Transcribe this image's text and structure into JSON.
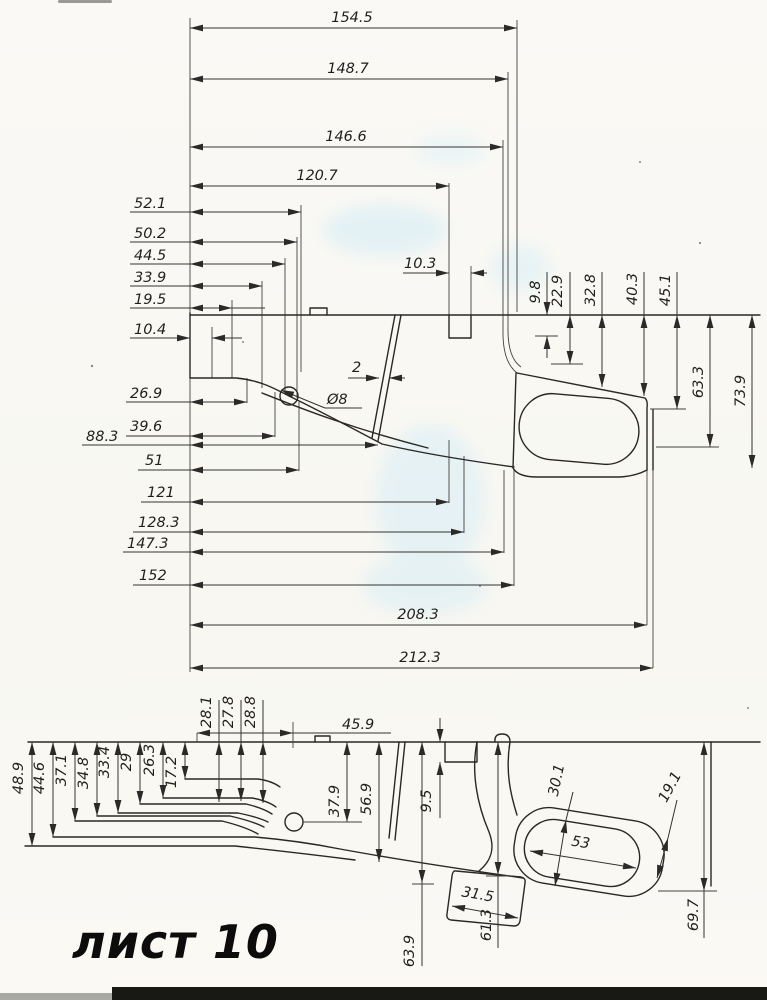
{
  "sheet_label": "лист 10",
  "colors": {
    "ink": "#2b2a28",
    "paper": "#f9f8f4",
    "stain": "#cfeaf4",
    "scan_bar": "#181815"
  },
  "top_view": {
    "top": [
      "154.5",
      "148.7",
      "146.6",
      "120.7"
    ],
    "left": [
      "52.1",
      "50.2",
      "44.5",
      "33.9",
      "19.5",
      "10.4"
    ],
    "mid": [
      "26.9",
      "39.6",
      "88.3",
      "51",
      "121",
      "128.3",
      "147.3",
      "152"
    ],
    "bottom": [
      "208.3",
      "212.3"
    ],
    "right": [
      "9.8",
      "22.9",
      "32.8",
      "40.3",
      "45.1",
      "63.3",
      "73.9"
    ],
    "slot": "2",
    "hole": "Ø8",
    "notch": "10.3"
  },
  "bottom_view": {
    "left": [
      "48.9",
      "44.6",
      "37.1",
      "34.8",
      "33.4",
      "29",
      "26.3",
      "17.2"
    ],
    "top": [
      "28.1",
      "27.8",
      "28.8",
      "45.9"
    ],
    "mid": [
      "37.9",
      "56.9",
      "9.5"
    ],
    "right": [
      "30.1",
      "19.1",
      "53",
      "31.5"
    ],
    "bottom": [
      "63.9",
      "61.3",
      "69.7"
    ]
  }
}
